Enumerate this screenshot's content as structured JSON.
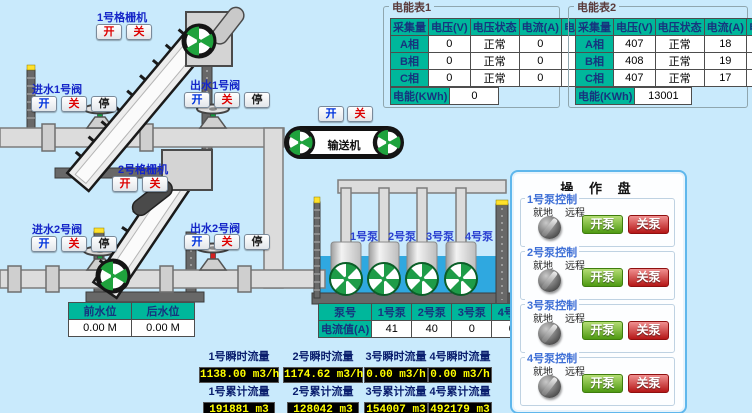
{
  "colors": {
    "bg": "#c9eafc",
    "teal": "#00b79b",
    "headerText": "#16347e",
    "water": "#2fa8e0",
    "yellow": "#ffff00",
    "labelBlue": "#1526c8",
    "panelBorder": "#5fb7ec",
    "btnGreen": "#4f9a12",
    "btnRed": "#b51616",
    "valveOpen": "#0f9e3c",
    "valveClosed": "#d42020"
  },
  "meter1": {
    "title": "电能表1",
    "headers": [
      "采集量",
      "电压(V)",
      "电压状态",
      "电流(A)",
      "电流状态"
    ],
    "rows": [
      [
        "A相",
        "0",
        "正常",
        "0",
        "正常"
      ],
      [
        "B相",
        "0",
        "正常",
        "0",
        "正常"
      ],
      [
        "C相",
        "0",
        "正常",
        "0",
        "正常"
      ]
    ],
    "energy_label": "电能(KWh)",
    "energy_value": "0"
  },
  "meter2": {
    "title": "电能表2",
    "headers": [
      "采集量",
      "电压(V)",
      "电压状态",
      "电流(A)",
      "电流状态"
    ],
    "rows": [
      [
        "A相",
        "407",
        "正常",
        "18",
        "正常"
      ],
      [
        "B相",
        "408",
        "正常",
        "19",
        "正常"
      ],
      [
        "C相",
        "407",
        "正常",
        "17",
        "正常"
      ]
    ],
    "energy_label": "电能(KWh)",
    "energy_value": "13001"
  },
  "grid1": {
    "label": "1号格栅机",
    "btn_open": "开",
    "btn_close": "关"
  },
  "grid2": {
    "label": "2号格栅机",
    "btn_open": "开",
    "btn_close": "关"
  },
  "conveyor": {
    "label": "输送机",
    "btn_open": "开",
    "btn_close": "关"
  },
  "valves": {
    "inlet1": {
      "label": "进水1号阀",
      "btn_open": "开",
      "btn_close": "关",
      "btn_stop": "停"
    },
    "outlet1": {
      "label": "出水1号阀",
      "btn_open": "开",
      "btn_close": "关",
      "btn_stop": "停"
    },
    "inlet2": {
      "label": "进水2号阀",
      "btn_open": "开",
      "btn_close": "关",
      "btn_stop": "停"
    },
    "outlet2": {
      "label": "出水2号阀",
      "btn_open": "开",
      "btn_close": "关",
      "btn_stop": "停"
    }
  },
  "pump_labels": [
    "1号泵",
    "2号泵",
    "3号泵",
    "4号泵"
  ],
  "current_table": {
    "corner": "泵号",
    "columns": [
      "1号泵",
      "2号泵",
      "3号泵",
      "4号泵"
    ],
    "row_label": "电流值(A)",
    "values": [
      "41",
      "40",
      "0",
      "0"
    ]
  },
  "level_table": {
    "headers": [
      "前水位",
      "后水位"
    ],
    "values": [
      "0.00 M",
      "0.00 M"
    ]
  },
  "flow_instant": [
    {
      "label": "1号瞬时流量",
      "value": "1138.00 m3/h"
    },
    {
      "label": "2号瞬时流量",
      "value": "1174.62 m3/h"
    },
    {
      "label": "3号瞬时流量",
      "value": "0.00 m3/h"
    },
    {
      "label": "4号瞬时流量",
      "value": "0.00 m3/h"
    }
  ],
  "flow_total": [
    {
      "label": "1号累计流量",
      "value": "191881 m3"
    },
    {
      "label": "2号累计流量",
      "value": "128042 m3"
    },
    {
      "label": "3号累计流量",
      "value": "154007 m3"
    },
    {
      "label": "4号累计流量",
      "value": "492179 m3"
    }
  ],
  "panel": {
    "title": "操 作 盘",
    "groups": [
      {
        "label": "1号泵控制",
        "local": "就地",
        "remote": "远程",
        "start": "开泵",
        "stop": "关泵"
      },
      {
        "label": "2号泵控制",
        "local": "就地",
        "remote": "远程",
        "start": "开泵",
        "stop": "关泵"
      },
      {
        "label": "3号泵控制",
        "local": "就地",
        "remote": "远程",
        "start": "开泵",
        "stop": "关泵"
      },
      {
        "label": "4号泵控制",
        "local": "就地",
        "remote": "远程",
        "start": "开泵",
        "stop": "关泵"
      }
    ]
  }
}
